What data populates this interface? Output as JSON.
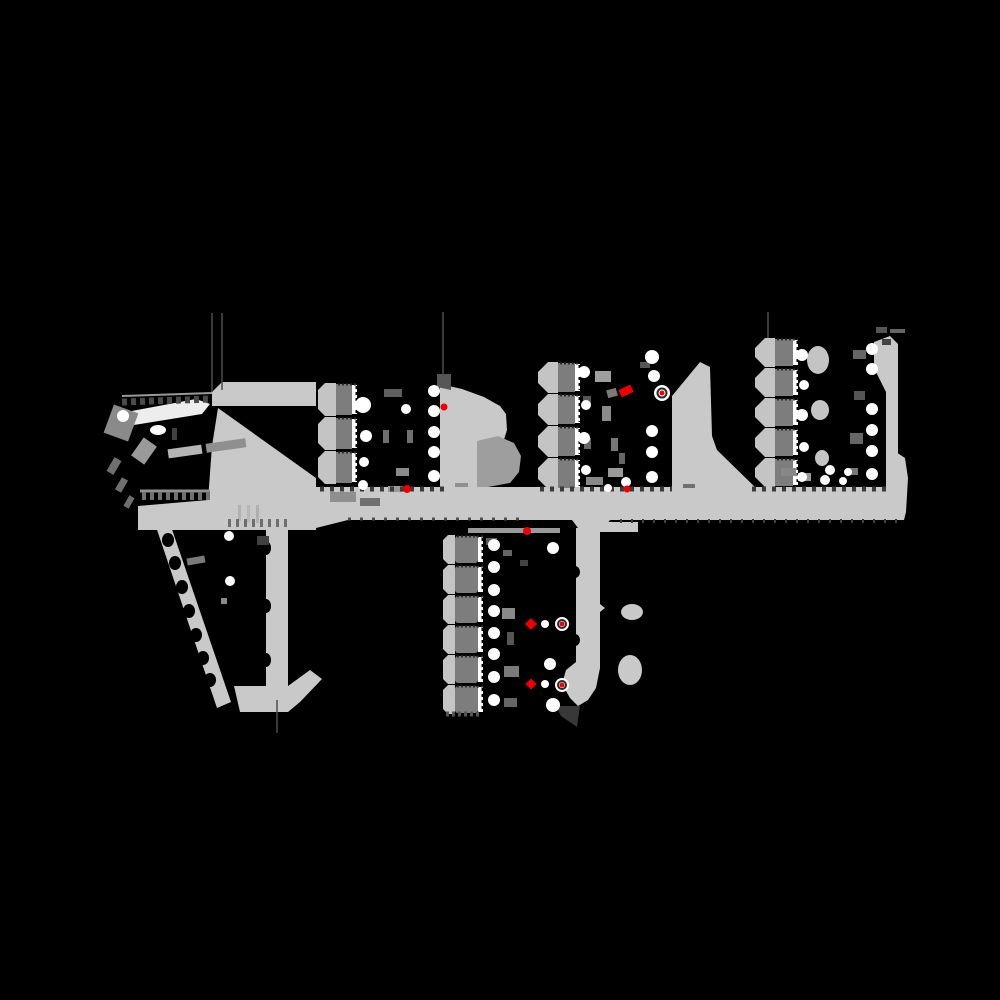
{
  "map": {
    "width": 1000,
    "height": 1000,
    "colors": {
      "background": "#000000",
      "free_space": "#c9c9c9",
      "free_dim": "#9e9e9e",
      "shelf_light": "#c4c4c4",
      "shelf_body": "#7d7d7d",
      "strip_white": "#ffffff",
      "scan_line": "#4c4c4c",
      "dark_wedge": "#383838",
      "blob_cap": "#565656",
      "marker": "#ee0000",
      "white": "#ffffff"
    },
    "regions": [
      {
        "name": "top-band-free-space",
        "fill": "free_space",
        "points": "212,392 222,382 316,382 316,406 212,406"
      },
      {
        "name": "left-free-space-wedge",
        "fill": "free_space",
        "points": "218,408 316,478 316,530 138,530 138,506 208,500 212,446"
      },
      {
        "name": "main-corridor",
        "fill": "free_space",
        "points": "316,487 888,487 888,458 896,452 905,458 908,478 906,512 904,520 640,520 610,520 604,528 578,528 572,520 348,520 316,528"
      },
      {
        "name": "right-corridor-stub",
        "fill": "free_space",
        "points": "886,392 898,392 898,490 886,490"
      },
      {
        "name": "top-right-free-patch",
        "fill": "free_space",
        "points": "874,342 890,336 898,344 898,392 886,392 874,368"
      },
      {
        "name": "center-free-blob",
        "fill": "free_space",
        "points": "440,384 462,389 484,397 500,406 506,414 507,430 502,446 495,464 489,478 486,487 440,487"
      },
      {
        "name": "center-dim-blob",
        "fill": "free_dim",
        "points": "477,441 498,436 514,443 521,456 519,472 510,483 488,487 477,487"
      },
      {
        "name": "block2-right-wedge",
        "fill": "free_space",
        "points": "700,362 710,367 712,436 717,450 757,489 757,508 672,508 672,396"
      },
      {
        "name": "diagonal-band",
        "fill": "free_space",
        "points": "149,506 164,506 231,702 217,708"
      },
      {
        "name": "left-vertical-corridor",
        "fill": "free_space",
        "points": "266,522 288,522 288,700 266,700"
      },
      {
        "name": "left-corridor-bottom",
        "fill": "free_space",
        "points": "234,686 288,686 310,670 322,679 300,702 288,712 240,712"
      },
      {
        "name": "block4-corridor",
        "fill": "free_space",
        "points": "576,528 600,528 600,604 605,608 600,612 600,668 596,688 588,700 578,706 570,698 562,684 566,670 576,662"
      },
      {
        "name": "block4-corridor-top-stub",
        "fill": "free_space",
        "points": "600,522 638,522 638,532 600,532"
      },
      {
        "name": "block4-dark-wedge",
        "fill": "dark_wedge",
        "points": "556,706 580,706 577,727 561,716"
      },
      {
        "name": "center-blob-cap",
        "fill": "blob_cap",
        "points": "437,374 451,374 451,390 437,387"
      }
    ],
    "ellipses": [
      {
        "x": 632,
        "y": 612,
        "rx": 11,
        "ry": 8,
        "fill": "free_space"
      },
      {
        "x": 630,
        "y": 670,
        "rx": 12,
        "ry": 15,
        "fill": "free_space"
      },
      {
        "x": 818,
        "y": 360,
        "rx": 11,
        "ry": 14,
        "fill": "shelf_light"
      },
      {
        "x": 820,
        "y": 410,
        "rx": 9,
        "ry": 10,
        "fill": "shelf_light"
      },
      {
        "x": 822,
        "y": 458,
        "rx": 7,
        "ry": 8,
        "fill": "shelf_light"
      },
      {
        "x": 158,
        "y": 430,
        "rx": 8,
        "ry": 5,
        "fill": "white"
      },
      {
        "x": 575,
        "y": 572,
        "rx": 5,
        "ry": 6,
        "fill": "background"
      },
      {
        "x": 575,
        "y": 640,
        "rx": 5,
        "ry": 6,
        "fill": "background"
      },
      {
        "x": 266,
        "y": 548,
        "rx": 5,
        "ry": 7,
        "fill": "background"
      },
      {
        "x": 266,
        "y": 606,
        "rx": 5,
        "ry": 7,
        "fill": "background"
      },
      {
        "x": 266,
        "y": 660,
        "rx": 5,
        "ry": 7,
        "fill": "background"
      },
      {
        "x": 168,
        "y": 540,
        "rx": 6,
        "ry": 7,
        "fill": "background"
      },
      {
        "x": 175,
        "y": 563,
        "rx": 6,
        "ry": 7,
        "fill": "background"
      },
      {
        "x": 182,
        "y": 587,
        "rx": 6,
        "ry": 7,
        "fill": "background"
      },
      {
        "x": 189,
        "y": 611,
        "rx": 6,
        "ry": 7,
        "fill": "background"
      },
      {
        "x": 196,
        "y": 635,
        "rx": 6,
        "ry": 7,
        "fill": "background"
      },
      {
        "x": 203,
        "y": 658,
        "rx": 6,
        "ry": 7,
        "fill": "background"
      },
      {
        "x": 210,
        "y": 680,
        "rx": 6,
        "ry": 7,
        "fill": "background"
      }
    ],
    "scan_lines": [
      {
        "x1": 212,
        "y1": 313,
        "x2": 212,
        "y2": 392
      },
      {
        "x1": 222,
        "y1": 313,
        "x2": 222,
        "y2": 390
      },
      {
        "x1": 443,
        "y1": 312,
        "x2": 443,
        "y2": 376
      },
      {
        "x1": 768,
        "y1": 312,
        "x2": 768,
        "y2": 340
      },
      {
        "x1": 277,
        "y1": 700,
        "x2": 277,
        "y2": 733
      }
    ],
    "shelf_blocks": [
      {
        "name": "aisle-block-1",
        "x": 318,
        "y": 383,
        "units": 3,
        "unit_h": 34,
        "light_w": 18,
        "body_w": 16,
        "strip_w": 5,
        "chamfer": 7,
        "rx": 0
      },
      {
        "name": "aisle-block-2",
        "x": 538,
        "y": 362,
        "units": 4,
        "unit_h": 32,
        "light_w": 20,
        "body_w": 17,
        "strip_w": 5,
        "chamfer": 10,
        "rx": 0
      },
      {
        "name": "aisle-block-3",
        "x": 755,
        "y": 338,
        "units": 5,
        "unit_h": 30,
        "light_w": 20,
        "body_w": 18,
        "strip_w": 5,
        "chamfer": 10,
        "rx": 0
      },
      {
        "name": "aisle-block-4",
        "x": 443,
        "y": 535,
        "units": 6,
        "unit_h": 30,
        "light_w": 12,
        "body_w": 23,
        "strip_w": 5,
        "chamfer": 5,
        "rx": 3
      }
    ],
    "marks": [
      {
        "x": 168,
        "y": 447,
        "w": 34,
        "h": 9,
        "fill": "#b5b5b5",
        "rot": -8
      },
      {
        "x": 206,
        "y": 441,
        "w": 40,
        "h": 9,
        "fill": "#8f8f8f",
        "rot": -8
      },
      {
        "x": 172,
        "y": 428,
        "w": 5,
        "h": 12,
        "fill": "#3f3f3f",
        "rot": 0
      },
      {
        "x": 108,
        "y": 408,
        "w": 26,
        "h": 30,
        "fill": "#8a8a8a",
        "rot": 20
      },
      {
        "x": 136,
        "y": 440,
        "w": 16,
        "h": 22,
        "fill": "#9a9a9a",
        "rot": 35
      },
      {
        "x": 110,
        "y": 458,
        "w": 8,
        "h": 16,
        "fill": "#6f6f6f",
        "rot": 30
      },
      {
        "x": 118,
        "y": 478,
        "w": 7,
        "h": 14,
        "fill": "#6f6f6f",
        "rot": 30
      },
      {
        "x": 126,
        "y": 496,
        "w": 6,
        "h": 12,
        "fill": "#6f6f6f",
        "rot": 30
      },
      {
        "x": 384,
        "y": 389,
        "w": 18,
        "h": 8,
        "fill": "#5f5f5f",
        "rot": 0
      },
      {
        "x": 383,
        "y": 430,
        "w": 6,
        "h": 13,
        "fill": "#6f6f6f",
        "rot": 0
      },
      {
        "x": 407,
        "y": 430,
        "w": 6,
        "h": 13,
        "fill": "#6f6f6f",
        "rot": 0
      },
      {
        "x": 396,
        "y": 468,
        "w": 13,
        "h": 8,
        "fill": "#8a8a8a",
        "rot": 0
      },
      {
        "x": 388,
        "y": 486,
        "w": 15,
        "h": 6,
        "fill": "#9a9a9a",
        "rot": 0
      },
      {
        "x": 330,
        "y": 492,
        "w": 26,
        "h": 10,
        "fill": "#8f8f8f",
        "rot": 0
      },
      {
        "x": 360,
        "y": 498,
        "w": 20,
        "h": 8,
        "fill": "#6f6f6f",
        "rot": 0
      },
      {
        "x": 595,
        "y": 371,
        "w": 16,
        "h": 11,
        "fill": "#9e9e9e",
        "rot": 0
      },
      {
        "x": 607,
        "y": 389,
        "w": 10,
        "h": 8,
        "fill": "#7a7a7a",
        "rot": -15
      },
      {
        "x": 602,
        "y": 406,
        "w": 9,
        "h": 15,
        "fill": "#8a8a8a",
        "rot": 0
      },
      {
        "x": 583,
        "y": 396,
        "w": 8,
        "h": 9,
        "fill": "#555555",
        "rot": 0
      },
      {
        "x": 611,
        "y": 438,
        "w": 7,
        "h": 13,
        "fill": "#777777",
        "rot": 0
      },
      {
        "x": 584,
        "y": 438,
        "w": 7,
        "h": 11,
        "fill": "#666666",
        "rot": 0
      },
      {
        "x": 608,
        "y": 468,
        "w": 15,
        "h": 9,
        "fill": "#999999",
        "rot": 0
      },
      {
        "x": 586,
        "y": 477,
        "w": 17,
        "h": 8,
        "fill": "#888888",
        "rot": 0
      },
      {
        "x": 619,
        "y": 453,
        "w": 6,
        "h": 11,
        "fill": "#666666",
        "rot": 0
      },
      {
        "x": 640,
        "y": 362,
        "w": 10,
        "h": 6,
        "fill": "#555555",
        "rot": 0
      },
      {
        "x": 853,
        "y": 350,
        "w": 13,
        "h": 9,
        "fill": "#666666",
        "rot": 0
      },
      {
        "x": 854,
        "y": 391,
        "w": 11,
        "h": 9,
        "fill": "#555555",
        "rot": 0
      },
      {
        "x": 850,
        "y": 433,
        "w": 13,
        "h": 11,
        "fill": "#666666",
        "rot": 0
      },
      {
        "x": 849,
        "y": 468,
        "w": 9,
        "h": 7,
        "fill": "#777777",
        "rot": 0
      },
      {
        "x": 798,
        "y": 473,
        "w": 13,
        "h": 8,
        "fill": "#999999",
        "rot": 0
      },
      {
        "x": 781,
        "y": 468,
        "w": 15,
        "h": 8,
        "fill": "#888888",
        "rot": 0
      },
      {
        "x": 876,
        "y": 327,
        "w": 11,
        "h": 6,
        "fill": "#555555",
        "rot": 0
      },
      {
        "x": 890,
        "y": 329,
        "w": 15,
        "h": 4,
        "fill": "#666666",
        "rot": 0
      },
      {
        "x": 882,
        "y": 339,
        "w": 9,
        "h": 6,
        "fill": "#444444",
        "rot": 0
      },
      {
        "x": 468,
        "y": 528,
        "w": 92,
        "h": 5,
        "fill": "#9a9a9a",
        "rot": 0
      },
      {
        "x": 486,
        "y": 538,
        "w": 11,
        "h": 7,
        "fill": "#5a5a5a",
        "rot": 0
      },
      {
        "x": 503,
        "y": 550,
        "w": 9,
        "h": 6,
        "fill": "#666666",
        "rot": 0
      },
      {
        "x": 502,
        "y": 608,
        "w": 13,
        "h": 11,
        "fill": "#8a8a8a",
        "rot": 0
      },
      {
        "x": 507,
        "y": 632,
        "w": 7,
        "h": 13,
        "fill": "#555555",
        "rot": 0
      },
      {
        "x": 504,
        "y": 666,
        "w": 15,
        "h": 11,
        "fill": "#7a7a7a",
        "rot": 0
      },
      {
        "x": 504,
        "y": 698,
        "w": 13,
        "h": 9,
        "fill": "#666666",
        "rot": 0
      },
      {
        "x": 520,
        "y": 560,
        "w": 8,
        "h": 6,
        "fill": "#444444",
        "rot": 0
      },
      {
        "x": 187,
        "y": 557,
        "w": 18,
        "h": 7,
        "fill": "#7a7a7a",
        "rot": -10
      },
      {
        "x": 221,
        "y": 598,
        "w": 6,
        "h": 6,
        "fill": "#8a8a8a",
        "rot": 0
      },
      {
        "x": 257,
        "y": 536,
        "w": 12,
        "h": 9,
        "fill": "#3f3f3f",
        "rot": 0
      },
      {
        "x": 247,
        "y": 505,
        "w": 3,
        "h": 18,
        "fill": "#b8b8b8",
        "rot": 0
      },
      {
        "x": 256,
        "y": 505,
        "w": 3,
        "h": 18,
        "fill": "#b0b0b0",
        "rot": 0
      },
      {
        "x": 238,
        "y": 505,
        "w": 3,
        "h": 16,
        "fill": "#b0b0b0",
        "rot": 0
      },
      {
        "x": 455,
        "y": 483,
        "w": 13,
        "h": 4,
        "fill": "#8f8f8f",
        "rot": 0
      },
      {
        "x": 683,
        "y": 484,
        "w": 12,
        "h": 4,
        "fill": "#6f6f6f",
        "rot": 0
      }
    ],
    "dashed_lines": [
      {
        "x1": 122,
        "y1": 396,
        "x2": 212,
        "y2": 393,
        "w": 2,
        "color": "#9a9a9a",
        "dash": "200 0"
      },
      {
        "x1": 122,
        "y1": 402,
        "x2": 212,
        "y2": 399,
        "w": 7,
        "color": "#4a4a4a",
        "dash": "5 4"
      },
      {
        "x1": 140,
        "y1": 491,
        "x2": 210,
        "y2": 491,
        "w": 3,
        "color": "#8f8f8f",
        "dash": "200 0"
      },
      {
        "x1": 142,
        "y1": 496,
        "x2": 210,
        "y2": 496,
        "w": 8,
        "color": "#707070",
        "dash": "4 4"
      },
      {
        "x1": 320,
        "y1": 489,
        "x2": 450,
        "y2": 489,
        "w": 5,
        "color": "#3a3a3a",
        "dash": "4 6"
      },
      {
        "x1": 540,
        "y1": 489,
        "x2": 672,
        "y2": 489,
        "w": 5,
        "color": "#3a3a3a",
        "dash": "4 6"
      },
      {
        "x1": 752,
        "y1": 489,
        "x2": 886,
        "y2": 489,
        "w": 5,
        "color": "#3a3a3a",
        "dash": "4 6"
      },
      {
        "x1": 620,
        "y1": 521,
        "x2": 902,
        "y2": 521,
        "w": 4,
        "color": "#3f3f3f",
        "dash": "2 9"
      },
      {
        "x1": 228,
        "y1": 523,
        "x2": 287,
        "y2": 523,
        "w": 8,
        "color": "#6e6e6e",
        "dash": "3 5"
      },
      {
        "x1": 348,
        "y1": 519,
        "x2": 520,
        "y2": 519,
        "w": 3,
        "color": "#4f4f4f",
        "dash": "3 9"
      },
      {
        "x1": 446,
        "y1": 714,
        "x2": 482,
        "y2": 714,
        "w": 5,
        "color": "#555555",
        "dash": "3 3"
      }
    ],
    "white_blobs": [
      {
        "x": 363,
        "y": 405,
        "r": 8
      },
      {
        "x": 366,
        "y": 436,
        "r": 6
      },
      {
        "x": 364,
        "y": 462,
        "r": 5
      },
      {
        "x": 363,
        "y": 485,
        "r": 5
      },
      {
        "x": 406,
        "y": 409,
        "r": 5
      },
      {
        "x": 434,
        "y": 391,
        "r": 6
      },
      {
        "x": 434,
        "y": 411,
        "r": 6
      },
      {
        "x": 434,
        "y": 432,
        "r": 6
      },
      {
        "x": 434,
        "y": 452,
        "r": 6
      },
      {
        "x": 434,
        "y": 476,
        "r": 6
      },
      {
        "x": 584,
        "y": 372,
        "r": 6
      },
      {
        "x": 586,
        "y": 405,
        "r": 5
      },
      {
        "x": 584,
        "y": 438,
        "r": 6
      },
      {
        "x": 586,
        "y": 470,
        "r": 5
      },
      {
        "x": 652,
        "y": 357,
        "r": 7
      },
      {
        "x": 654,
        "y": 376,
        "r": 6
      },
      {
        "x": 652,
        "y": 431,
        "r": 6
      },
      {
        "x": 652,
        "y": 452,
        "r": 6
      },
      {
        "x": 652,
        "y": 477,
        "r": 6
      },
      {
        "x": 626,
        "y": 482,
        "r": 5
      },
      {
        "x": 608,
        "y": 488,
        "r": 4
      },
      {
        "x": 662,
        "y": 393,
        "r": 8
      },
      {
        "x": 802,
        "y": 355,
        "r": 6
      },
      {
        "x": 804,
        "y": 385,
        "r": 5
      },
      {
        "x": 802,
        "y": 415,
        "r": 6
      },
      {
        "x": 804,
        "y": 447,
        "r": 5
      },
      {
        "x": 802,
        "y": 477,
        "r": 5
      },
      {
        "x": 872,
        "y": 349,
        "r": 6
      },
      {
        "x": 872,
        "y": 369,
        "r": 6
      },
      {
        "x": 872,
        "y": 409,
        "r": 6
      },
      {
        "x": 872,
        "y": 430,
        "r": 6
      },
      {
        "x": 872,
        "y": 451,
        "r": 6
      },
      {
        "x": 872,
        "y": 474,
        "r": 6
      },
      {
        "x": 825,
        "y": 480,
        "r": 5
      },
      {
        "x": 843,
        "y": 481,
        "r": 4
      },
      {
        "x": 830,
        "y": 470,
        "r": 5
      },
      {
        "x": 848,
        "y": 472,
        "r": 4
      },
      {
        "x": 494,
        "y": 545,
        "r": 6
      },
      {
        "x": 494,
        "y": 567,
        "r": 6
      },
      {
        "x": 494,
        "y": 590,
        "r": 6
      },
      {
        "x": 494,
        "y": 611,
        "r": 6
      },
      {
        "x": 494,
        "y": 633,
        "r": 6
      },
      {
        "x": 494,
        "y": 654,
        "r": 6
      },
      {
        "x": 494,
        "y": 677,
        "r": 6
      },
      {
        "x": 494,
        "y": 700,
        "r": 6
      },
      {
        "x": 553,
        "y": 548,
        "r": 6
      },
      {
        "x": 550,
        "y": 664,
        "r": 6
      },
      {
        "x": 553,
        "y": 705,
        "r": 7
      },
      {
        "x": 562,
        "y": 624,
        "r": 7
      },
      {
        "x": 562,
        "y": 685,
        "r": 7
      },
      {
        "x": 545,
        "y": 624,
        "r": 4
      },
      {
        "x": 545,
        "y": 684,
        "r": 4
      },
      {
        "x": 229,
        "y": 536,
        "r": 5
      },
      {
        "x": 230,
        "y": 581,
        "r": 5
      },
      {
        "x": 123,
        "y": 416,
        "r": 6
      }
    ],
    "rings": [
      {
        "x": 662,
        "y": 393,
        "r": 4.5
      },
      {
        "x": 562,
        "y": 624,
        "r": 4
      },
      {
        "x": 562,
        "y": 685,
        "r": 4
      }
    ],
    "room": {
      "bar_points": "126,412 196,399 210,404 202,414 134,425",
      "bar_fill": "#ededed"
    },
    "markers": [
      {
        "x": 444,
        "y": 407,
        "shape": "dot",
        "s": 3.5
      },
      {
        "x": 407,
        "y": 489,
        "shape": "dot",
        "s": 4
      },
      {
        "x": 626,
        "y": 391,
        "shape": "rect",
        "s": 6,
        "w": 13,
        "h": 8,
        "rot": -25
      },
      {
        "x": 662,
        "y": 393,
        "shape": "dot",
        "s": 2.5
      },
      {
        "x": 627,
        "y": 489,
        "shape": "dot",
        "s": 3.5
      },
      {
        "x": 527,
        "y": 531,
        "shape": "dot",
        "s": 4
      },
      {
        "x": 531,
        "y": 624,
        "shape": "diamond",
        "s": 6
      },
      {
        "x": 562,
        "y": 624,
        "shape": "dot",
        "s": 2.5
      },
      {
        "x": 531,
        "y": 684,
        "shape": "diamond",
        "s": 5.5
      },
      {
        "x": 562,
        "y": 685,
        "shape": "dot",
        "s": 2.5
      }
    ]
  }
}
